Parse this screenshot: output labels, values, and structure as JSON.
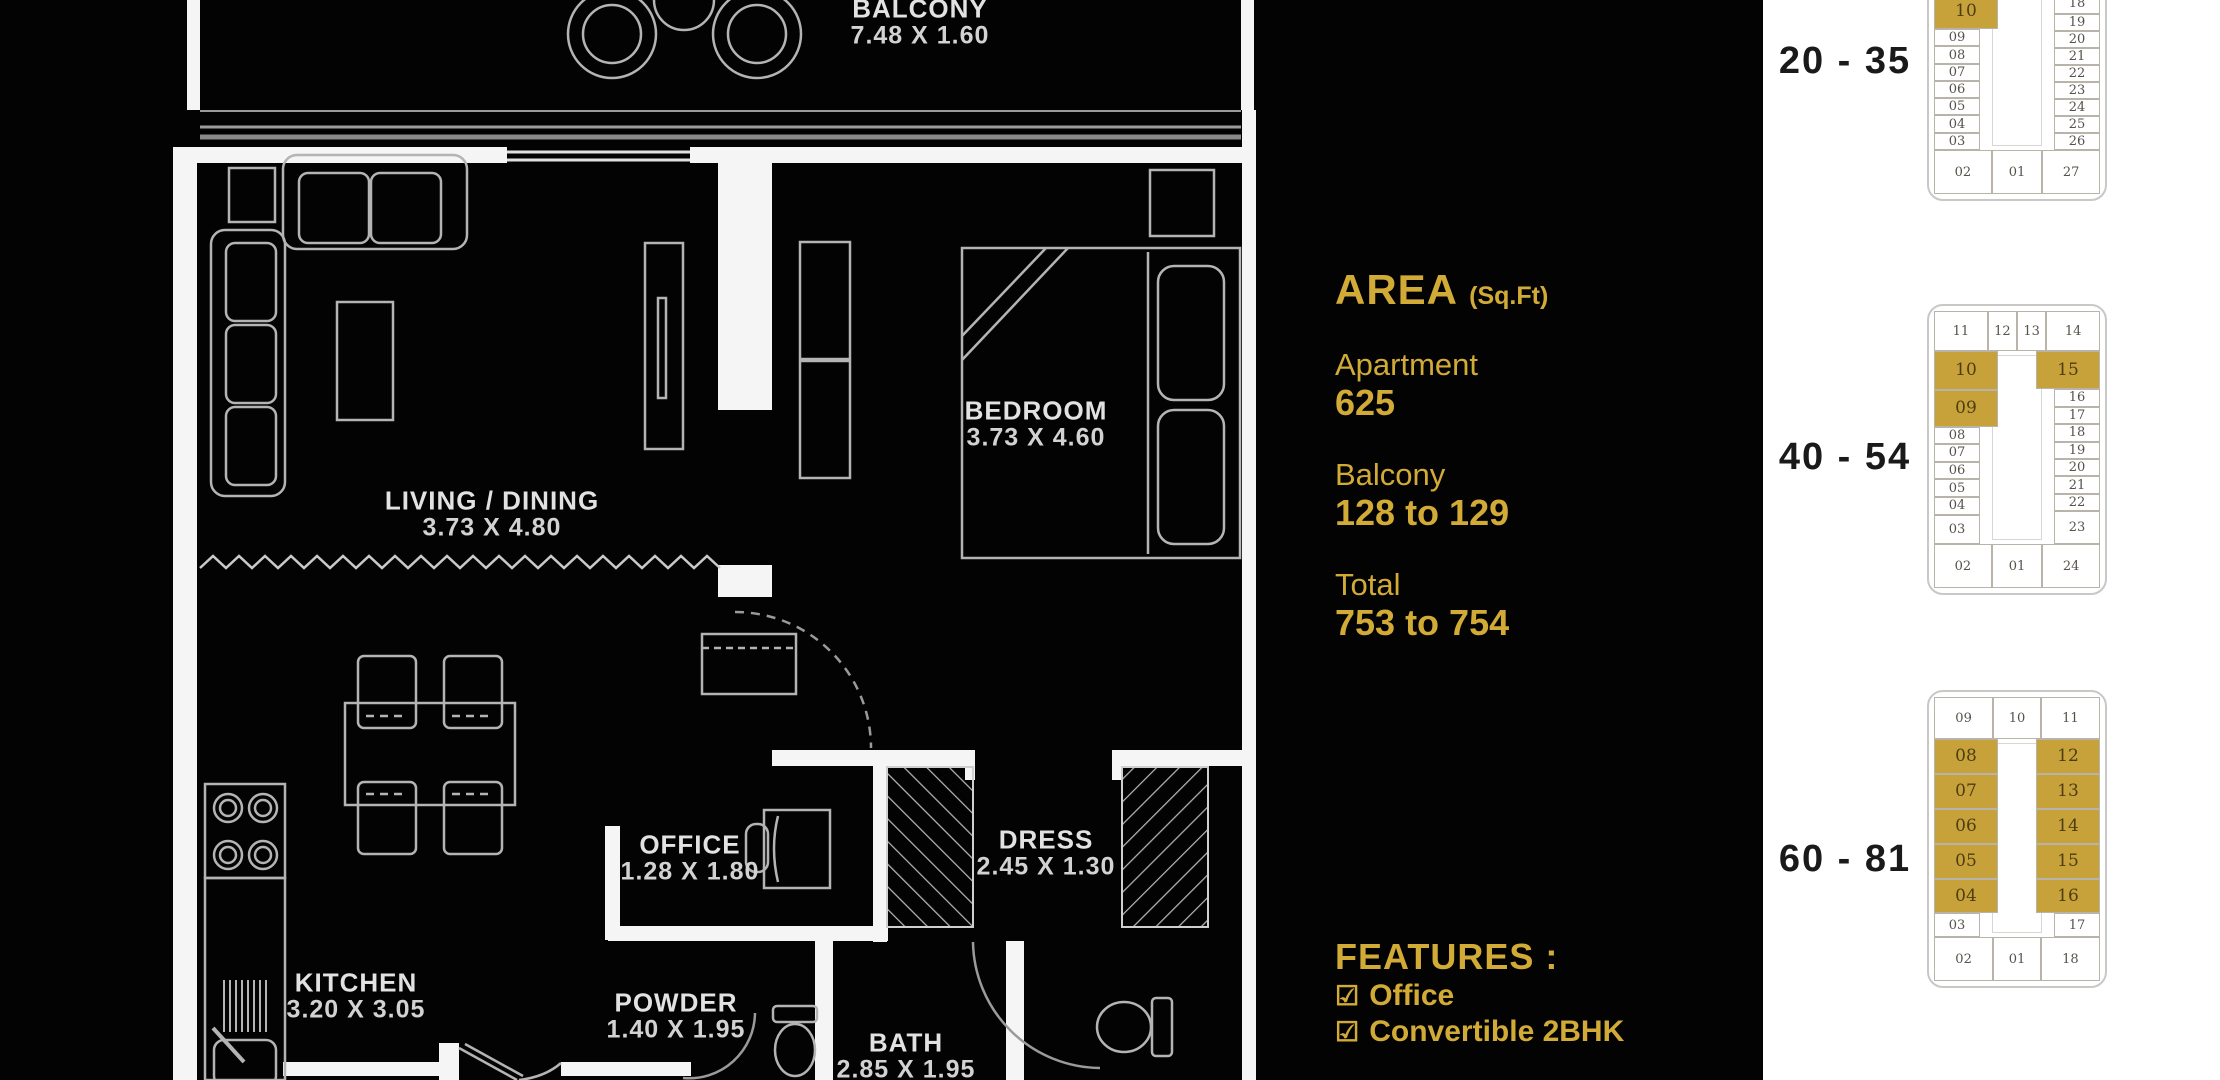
{
  "colors": {
    "background": "#000000",
    "gold_text": "#d2ab37",
    "plan_highlight": "#c7a23b",
    "panel_background": "#ffffff",
    "wall_white": "#f5f5f5"
  },
  "floor_plan": {
    "rooms": [
      {
        "name": "BALCONY",
        "dims": "7.48 X 1.60"
      },
      {
        "name": "LIVING / DINING",
        "dims": "3.73 X 4.80"
      },
      {
        "name": "BEDROOM",
        "dims": "3.73 X 4.60"
      },
      {
        "name": "KITCHEN",
        "dims": "3.20 X 3.05"
      },
      {
        "name": "OFFICE",
        "dims": "1.28 X 1.80"
      },
      {
        "name": "POWDER",
        "dims": "1.40 X 1.95"
      },
      {
        "name": "BATH",
        "dims": "2.85 X 1.95"
      },
      {
        "name": "DRESS",
        "dims": "2.45 X 1.30"
      }
    ]
  },
  "area_panel": {
    "title": "AREA",
    "unit": "(Sq.Ft)",
    "rows": [
      {
        "label": "Apartment",
        "value": "625"
      },
      {
        "label": "Balcony",
        "value": "128 to 129"
      },
      {
        "label": "Total",
        "value": "753 to 754"
      }
    ]
  },
  "features_panel": {
    "title": "FEATURES :",
    "check": "☑",
    "items": [
      "Office",
      "Convertible 2BHK"
    ]
  },
  "key_plans": [
    {
      "range": "20 - 35",
      "top": [],
      "top_h": 0,
      "left": [
        {
          "t": "10",
          "g": true,
          "h": 38
        },
        {
          "t": "09",
          "h": 17
        },
        {
          "t": "08",
          "h": 17
        },
        {
          "t": "07",
          "h": 17
        },
        {
          "t": "06",
          "h": 17
        },
        {
          "t": "05",
          "h": 17
        },
        {
          "t": "04",
          "h": 17
        },
        {
          "t": "03",
          "h": 17
        }
      ],
      "right": [
        {
          "t": "18",
          "h": 21
        },
        {
          "t": "19",
          "h": 17
        },
        {
          "t": "20",
          "h": 17
        },
        {
          "t": "21",
          "h": 17
        },
        {
          "t": "22",
          "h": 17
        },
        {
          "t": "23",
          "h": 17
        },
        {
          "t": "24",
          "h": 17
        },
        {
          "t": "25",
          "h": 17
        },
        {
          "t": "26",
          "h": 17
        }
      ],
      "bottom": [
        {
          "t": "02",
          "w": 1.15
        },
        {
          "t": "01",
          "w": 1
        },
        {
          "t": "27",
          "w": 1.15
        }
      ],
      "bottom_h": 44
    },
    {
      "range": "40 - 54",
      "top": [
        {
          "t": "11",
          "w": 1.9
        },
        {
          "t": "12",
          "w": 1
        },
        {
          "t": "13",
          "w": 1
        },
        {
          "t": "14",
          "w": 1.9
        }
      ],
      "top_h": 40,
      "left": [
        {
          "t": "10",
          "g": true,
          "h": 40
        },
        {
          "t": "09",
          "g": true,
          "h": 38
        },
        {
          "t": "08",
          "h": 17
        },
        {
          "t": "07",
          "h": 17
        },
        {
          "t": "06",
          "h": 17
        },
        {
          "t": "05",
          "h": 17
        },
        {
          "t": "04",
          "h": 17
        },
        {
          "t": "03",
          "h": 30
        }
      ],
      "right": [
        {
          "t": "15",
          "g": true,
          "h": 40
        },
        {
          "t": "16",
          "h": 17
        },
        {
          "t": "17",
          "h": 17
        },
        {
          "t": "18",
          "h": 17
        },
        {
          "t": "19",
          "h": 17
        },
        {
          "t": "20",
          "h": 17
        },
        {
          "t": "21",
          "h": 17
        },
        {
          "t": "22",
          "h": 17
        },
        {
          "t": "23",
          "h": 34
        }
      ],
      "bottom": [
        {
          "t": "02",
          "w": 1.15
        },
        {
          "t": "01",
          "w": 1
        },
        {
          "t": "24",
          "w": 1.15
        }
      ],
      "bottom_h": 44
    },
    {
      "range": "60 - 81",
      "top": [
        {
          "t": "09",
          "w": 1.25
        },
        {
          "t": "10",
          "w": 1
        },
        {
          "t": "11",
          "w": 1.25
        }
      ],
      "top_h": 42,
      "left": [
        {
          "t": "08",
          "g": true,
          "h": 35
        },
        {
          "t": "07",
          "g": true,
          "h": 35
        },
        {
          "t": "06",
          "g": true,
          "h": 35
        },
        {
          "t": "05",
          "g": true,
          "h": 35
        },
        {
          "t": "04",
          "g": true,
          "h": 35
        },
        {
          "t": "03",
          "h": 23
        }
      ],
      "right": [
        {
          "t": "12",
          "g": true,
          "h": 35
        },
        {
          "t": "13",
          "g": true,
          "h": 35
        },
        {
          "t": "14",
          "g": true,
          "h": 35
        },
        {
          "t": "15",
          "g": true,
          "h": 35
        },
        {
          "t": "16",
          "g": true,
          "h": 35
        },
        {
          "t": "17",
          "h": 23
        }
      ],
      "bottom": [
        {
          "t": "02",
          "w": 1.25
        },
        {
          "t": "01",
          "w": 1
        },
        {
          "t": "18",
          "w": 1.25
        }
      ],
      "bottom_h": 44
    }
  ]
}
